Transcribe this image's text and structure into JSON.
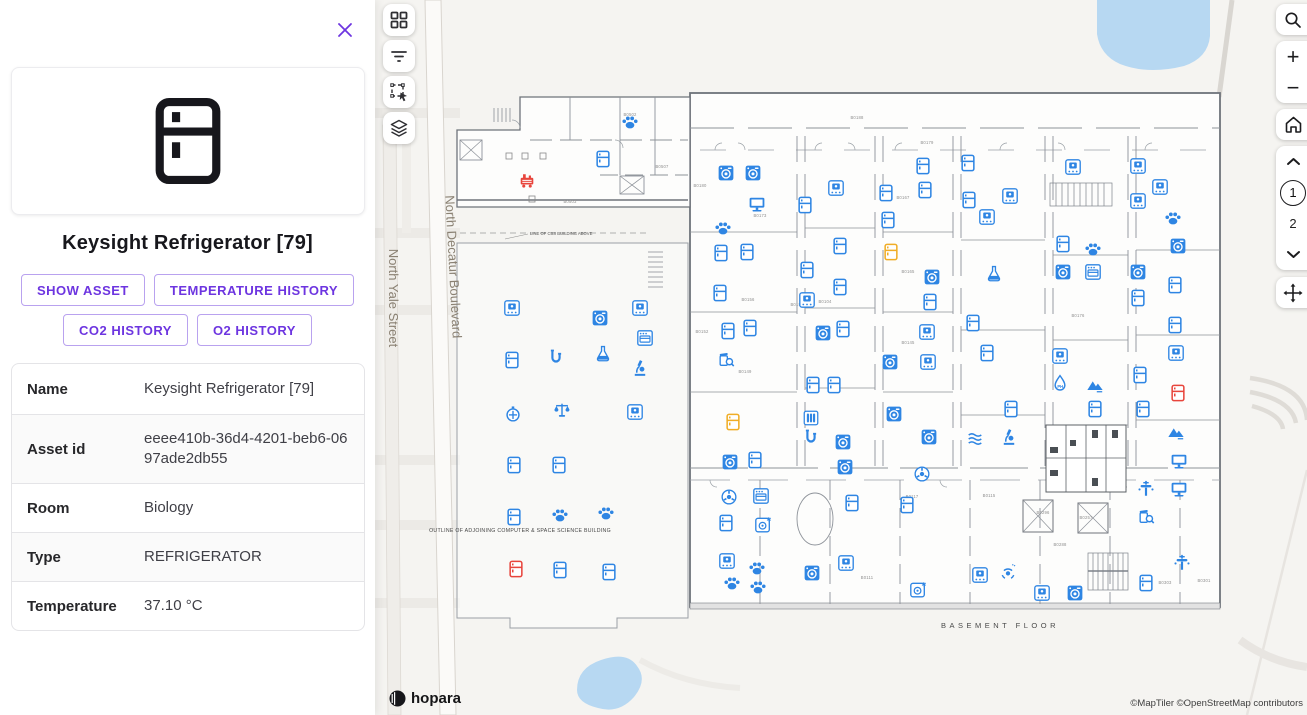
{
  "panel": {
    "title": "Keysight Refrigerator [79]",
    "close_icon": "x",
    "buttons": [
      "SHOW ASSET",
      "TEMPERATURE HISTORY",
      "CO2 HISTORY",
      "O2 HISTORY"
    ],
    "details": [
      {
        "label": "Name",
        "value": "Keysight Refrigerator [79]"
      },
      {
        "label": "Asset id",
        "value": "eeee410b-36d4-4201-beb6-0697ade2db55"
      },
      {
        "label": "Room",
        "value": "Biology"
      },
      {
        "label": "Type",
        "value": "REFRIGERATOR"
      },
      {
        "label": "Temperature",
        "value": "37.10 °C"
      }
    ]
  },
  "map": {
    "controls": {
      "zoom_in": "+",
      "zoom_out": "−",
      "floor_current": "1",
      "floor_next": "2"
    },
    "streets": {
      "yale": "North Yale Street",
      "decatur": "North Decatur Boulevard"
    },
    "plan_texts": {
      "basement": "BASEMENT FLOOR",
      "outline": "OUTLINE OF ADJOINING COMPUTER & SPACE SCIENCE BUILDING",
      "line_of": "LINE OF CSS BUILDING ABOVE"
    },
    "logo": "hopara",
    "attribution": "©MapTiler ©OpenStreetMap contributors",
    "colors": {
      "blue": "#2e85e3",
      "red": "#e8453c",
      "yellow": "#f0ad26"
    },
    "room_labels": [
      {
        "text": "B0188",
        "x": 857,
        "y": 119
      },
      {
        "text": "B0179",
        "x": 927,
        "y": 144
      },
      {
        "text": "B0180",
        "x": 700,
        "y": 187
      },
      {
        "text": "B0173",
        "x": 760,
        "y": 217
      },
      {
        "text": "B0156",
        "x": 748,
        "y": 301
      },
      {
        "text": "B0152",
        "x": 702,
        "y": 333
      },
      {
        "text": "B0149",
        "x": 745,
        "y": 373
      },
      {
        "text": "B0194",
        "x": 797,
        "y": 306
      },
      {
        "text": "B0104",
        "x": 825,
        "y": 303
      },
      {
        "text": "B0167",
        "x": 903,
        "y": 199
      },
      {
        "text": "B0165",
        "x": 908,
        "y": 273
      },
      {
        "text": "B0145",
        "x": 908,
        "y": 344
      },
      {
        "text": "B0117",
        "x": 912,
        "y": 498
      },
      {
        "text": "B0115",
        "x": 989,
        "y": 497
      },
      {
        "text": "B0176",
        "x": 1078,
        "y": 317
      },
      {
        "text": "B0296",
        "x": 1043,
        "y": 514
      },
      {
        "text": "B0257",
        "x": 1086,
        "y": 519
      },
      {
        "text": "B0288",
        "x": 1060,
        "y": 546
      },
      {
        "text": "B0111",
        "x": 867,
        "y": 579
      },
      {
        "text": "B0303",
        "x": 1165,
        "y": 584
      },
      {
        "text": "B0301",
        "x": 1204,
        "y": 582
      },
      {
        "text": "B0502",
        "x": 630,
        "y": 116
      },
      {
        "text": "B0503",
        "x": 570,
        "y": 203
      },
      {
        "text": "B0507",
        "x": 662,
        "y": 168
      }
    ],
    "icons": [
      {
        "t": "pump",
        "x": 527,
        "y": 180,
        "c": "red"
      },
      {
        "t": "paw",
        "x": 630,
        "y": 122
      },
      {
        "t": "fridge",
        "x": 603,
        "y": 159
      },
      {
        "t": "incubator",
        "x": 512,
        "y": 308
      },
      {
        "t": "washer",
        "x": 600,
        "y": 318
      },
      {
        "t": "incubator",
        "x": 640,
        "y": 308
      },
      {
        "t": "oven",
        "x": 645,
        "y": 338
      },
      {
        "t": "fridge",
        "x": 512,
        "y": 360
      },
      {
        "t": "pipe",
        "x": 556,
        "y": 357
      },
      {
        "t": "flask",
        "x": 603,
        "y": 353
      },
      {
        "t": "microscope",
        "x": 640,
        "y": 368
      },
      {
        "t": "timer",
        "x": 513,
        "y": 414
      },
      {
        "t": "scale",
        "x": 562,
        "y": 410
      },
      {
        "t": "incubator",
        "x": 635,
        "y": 412
      },
      {
        "t": "fridge",
        "x": 514,
        "y": 465
      },
      {
        "t": "fridge",
        "x": 559,
        "y": 465
      },
      {
        "t": "fridge",
        "x": 514,
        "y": 517
      },
      {
        "t": "paw",
        "x": 560,
        "y": 515
      },
      {
        "t": "paw",
        "x": 606,
        "y": 513
      },
      {
        "t": "fridge",
        "x": 516,
        "y": 569,
        "c": "red"
      },
      {
        "t": "fridge",
        "x": 560,
        "y": 570
      },
      {
        "t": "fridge",
        "x": 609,
        "y": 572
      },
      {
        "t": "washer",
        "x": 726,
        "y": 173
      },
      {
        "t": "washer",
        "x": 753,
        "y": 173
      },
      {
        "t": "monitor",
        "x": 757,
        "y": 204
      },
      {
        "t": "paw",
        "x": 723,
        "y": 228
      },
      {
        "t": "fridge",
        "x": 721,
        "y": 253
      },
      {
        "t": "fridge",
        "x": 747,
        "y": 252
      },
      {
        "t": "fridge",
        "x": 720,
        "y": 293
      },
      {
        "t": "fridge",
        "x": 728,
        "y": 331
      },
      {
        "t": "fridge",
        "x": 750,
        "y": 328
      },
      {
        "t": "jarsearch",
        "x": 726,
        "y": 359
      },
      {
        "t": "incubator",
        "x": 836,
        "y": 188
      },
      {
        "t": "fridge",
        "x": 805,
        "y": 205
      },
      {
        "t": "fridge",
        "x": 840,
        "y": 246
      },
      {
        "t": "fridge",
        "x": 807,
        "y": 270
      },
      {
        "t": "fridge",
        "x": 840,
        "y": 287
      },
      {
        "t": "incubator",
        "x": 807,
        "y": 300
      },
      {
        "t": "washer",
        "x": 823,
        "y": 333
      },
      {
        "t": "fridge",
        "x": 843,
        "y": 329
      },
      {
        "t": "fridge",
        "x": 813,
        "y": 385
      },
      {
        "t": "fridge",
        "x": 834,
        "y": 385
      },
      {
        "t": "fridge",
        "x": 886,
        "y": 193
      },
      {
        "t": "fridge",
        "x": 888,
        "y": 220
      },
      {
        "t": "fridge",
        "x": 891,
        "y": 252,
        "c": "yellow"
      },
      {
        "t": "washer",
        "x": 932,
        "y": 277
      },
      {
        "t": "fridge",
        "x": 930,
        "y": 302
      },
      {
        "t": "washer",
        "x": 890,
        "y": 362
      },
      {
        "t": "fridge",
        "x": 923,
        "y": 166
      },
      {
        "t": "fridge",
        "x": 925,
        "y": 190
      },
      {
        "t": "incubator",
        "x": 927,
        "y": 332
      },
      {
        "t": "incubator",
        "x": 928,
        "y": 362
      },
      {
        "t": "fridge",
        "x": 968,
        "y": 163
      },
      {
        "t": "fridge",
        "x": 969,
        "y": 200
      },
      {
        "t": "incubator",
        "x": 987,
        "y": 217
      },
      {
        "t": "flask",
        "x": 994,
        "y": 273
      },
      {
        "t": "fridge",
        "x": 973,
        "y": 323
      },
      {
        "t": "fridge",
        "x": 987,
        "y": 353
      },
      {
        "t": "incubator",
        "x": 1073,
        "y": 167
      },
      {
        "t": "incubator",
        "x": 1010,
        "y": 196
      },
      {
        "t": "incubator",
        "x": 1138,
        "y": 166
      },
      {
        "t": "incubator",
        "x": 1160,
        "y": 187
      },
      {
        "t": "incubator",
        "x": 1138,
        "y": 201
      },
      {
        "t": "paw",
        "x": 1173,
        "y": 218
      },
      {
        "t": "fridge",
        "x": 1063,
        "y": 244
      },
      {
        "t": "paw",
        "x": 1093,
        "y": 249
      },
      {
        "t": "washer",
        "x": 1063,
        "y": 272
      },
      {
        "t": "oven",
        "x": 1093,
        "y": 272
      },
      {
        "t": "washer",
        "x": 1178,
        "y": 246
      },
      {
        "t": "washer",
        "x": 1138,
        "y": 272
      },
      {
        "t": "fridge",
        "x": 1175,
        "y": 285
      },
      {
        "t": "fridge",
        "x": 1138,
        "y": 298
      },
      {
        "t": "fridge",
        "x": 1175,
        "y": 325
      },
      {
        "t": "incubator",
        "x": 1060,
        "y": 356
      },
      {
        "t": "ph",
        "x": 1060,
        "y": 383
      },
      {
        "t": "mountain",
        "x": 1095,
        "y": 385
      },
      {
        "t": "incubator",
        "x": 1176,
        "y": 353
      },
      {
        "t": "fridge",
        "x": 1140,
        "y": 375
      },
      {
        "t": "fridge",
        "x": 1178,
        "y": 393,
        "c": "red"
      },
      {
        "t": "fridge",
        "x": 733,
        "y": 422,
        "c": "yellow"
      },
      {
        "t": "washer",
        "x": 730,
        "y": 462
      },
      {
        "t": "fridge",
        "x": 755,
        "y": 460
      },
      {
        "t": "atom",
        "x": 729,
        "y": 497
      },
      {
        "t": "oven",
        "x": 761,
        "y": 496
      },
      {
        "t": "fridge",
        "x": 726,
        "y": 523
      },
      {
        "t": "washer2",
        "x": 763,
        "y": 525
      },
      {
        "t": "incubator",
        "x": 727,
        "y": 561
      },
      {
        "t": "paw",
        "x": 757,
        "y": 568
      },
      {
        "t": "paw",
        "x": 732,
        "y": 583
      },
      {
        "t": "paw",
        "x": 758,
        "y": 587
      },
      {
        "t": "tubes",
        "x": 811,
        "y": 418
      },
      {
        "t": "pipe",
        "x": 811,
        "y": 437
      },
      {
        "t": "washer",
        "x": 843,
        "y": 442
      },
      {
        "t": "washer",
        "x": 845,
        "y": 467
      },
      {
        "t": "fridge",
        "x": 852,
        "y": 503
      },
      {
        "t": "washer",
        "x": 812,
        "y": 573
      },
      {
        "t": "incubator",
        "x": 846,
        "y": 563
      },
      {
        "t": "washer",
        "x": 894,
        "y": 414
      },
      {
        "t": "washer",
        "x": 929,
        "y": 437
      },
      {
        "t": "atom",
        "x": 922,
        "y": 474
      },
      {
        "t": "fridge",
        "x": 907,
        "y": 505
      },
      {
        "t": "waves",
        "x": 975,
        "y": 439
      },
      {
        "t": "washer2",
        "x": 918,
        "y": 590
      },
      {
        "t": "incubator",
        "x": 980,
        "y": 575
      },
      {
        "t": "fridge",
        "x": 1011,
        "y": 409
      },
      {
        "t": "microscope",
        "x": 1009,
        "y": 437
      },
      {
        "t": "fridge",
        "x": 1095,
        "y": 409
      },
      {
        "t": "fridge",
        "x": 1143,
        "y": 409
      },
      {
        "t": "mountain",
        "x": 1176,
        "y": 432
      },
      {
        "t": "monitor",
        "x": 1179,
        "y": 461
      },
      {
        "t": "valve",
        "x": 1146,
        "y": 489
      },
      {
        "t": "monitor",
        "x": 1179,
        "y": 489
      },
      {
        "t": "jarsearch",
        "x": 1146,
        "y": 516
      },
      {
        "t": "sprinkler",
        "x": 1008,
        "y": 572
      },
      {
        "t": "incubator",
        "x": 1042,
        "y": 593
      },
      {
        "t": "washer",
        "x": 1075,
        "y": 593
      },
      {
        "t": "fridge",
        "x": 1146,
        "y": 583
      },
      {
        "t": "valve",
        "x": 1182,
        "y": 563
      }
    ]
  }
}
